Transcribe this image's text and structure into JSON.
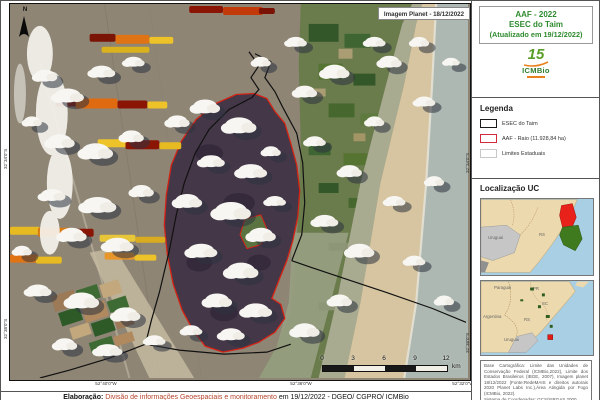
{
  "header": {
    "title_line1": "AAF - 2022",
    "title_line2": "ESEC do Taim",
    "title_line3": "(Atualizado em 19/12/2022)"
  },
  "logo": {
    "years": "15",
    "name": "ICMBio"
  },
  "map": {
    "north_label": "N",
    "image_label": "Imagem Planet - 18/12/2022",
    "coordinates": {
      "bottom": [
        "52°40'0\"W",
        "52°36'0\"W",
        "52°32'0\"W"
      ],
      "left_top": "32°34'0\"S",
      "left_bottom": "32°38'0\"S",
      "right_top": "32°34'0\"S",
      "right_bottom": "32°38'0\"S"
    },
    "scale_bar": {
      "ticks": [
        "0",
        "3",
        "6",
        "9",
        "12"
      ],
      "unit": "km"
    }
  },
  "legend": {
    "heading": "Legenda",
    "items": [
      {
        "label": "ESEC do Taim",
        "color": "#1a1a1a"
      },
      {
        "label": "AAF - Raio (11.928,84 ha)",
        "color": "#d3283c"
      },
      {
        "label": "Limites Estaduais",
        "color": "#c8c8c8"
      }
    ]
  },
  "location": {
    "heading": "Localização UC",
    "inset1": {
      "labels": [
        "Uruguai",
        "RS"
      ]
    },
    "inset2": {
      "labels": [
        "Paraguai",
        "PR",
        "SC",
        "Argentina",
        "RS",
        "Uruguai"
      ]
    }
  },
  "credits": {
    "text": "Base Cartográfica: Limite das Unidades de Conservação Federal (ICMBio,2022), Limite dos Estados Brasileiros (IBGE, 2007), Imagem planet 18/12/2022 (Fonte:RedeMAIS e direitos autorais 2020 Planet Labs Inc.),Área Atingida por Fogo (ICMBio, 2022).",
    "coordinate_system": "Sistema de Coordenadas: GCS/SIRGAS 2000."
  },
  "footer": {
    "label": "Elaboração:",
    "team": "Divisão de informações Geoespaciais e monitoramento",
    "suffix": "em 19/12/2022 - DGEO/ CGPRO/ ICMBio"
  },
  "colors": {
    "title_green": "#2e8b2e",
    "aaf_red": "#d3283c",
    "burn_fill": "#443748",
    "ocean_gray": "#aeb8b2",
    "inset_ocean_blue": "#a9cfe5",
    "inset_land_tan": "#ecd9ad",
    "footer_red": "#b5442c"
  }
}
